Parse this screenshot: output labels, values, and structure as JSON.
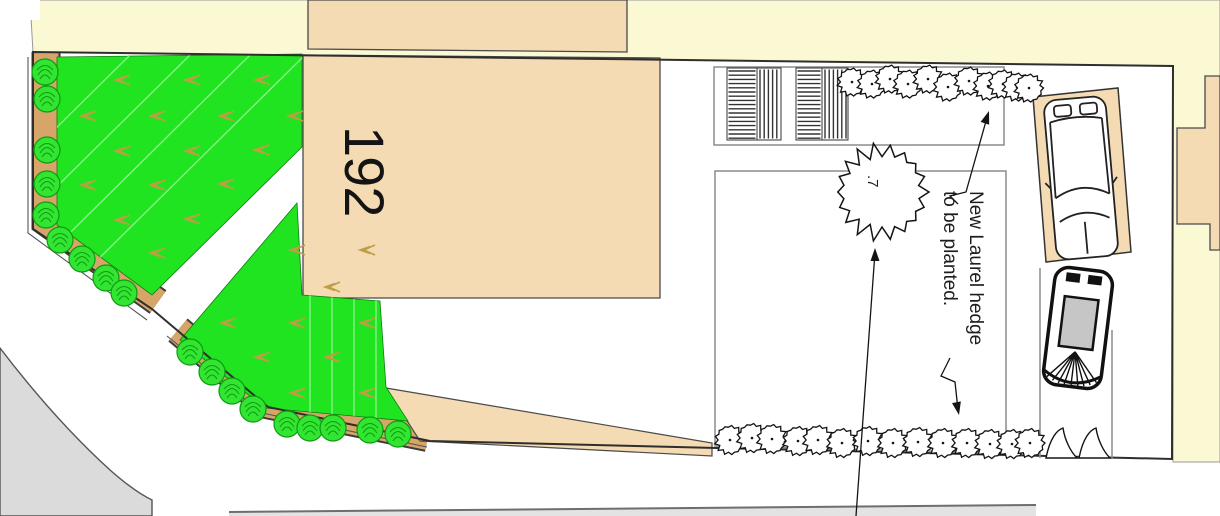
{
  "document": {
    "type": "landscape-site-plan"
  },
  "labels": {
    "house_number": "192",
    "annotation_line1": "New Laurel hedge",
    "annotation_line2": "to be planted.",
    "tree_label": ".7"
  },
  "colors": {
    "road_cream": "#FBF8D4",
    "building_tan": "#F5DBB3",
    "hedge_strip_brown": "#D7A569",
    "lawn_green": "#1FE41F",
    "lawn_stripe": "#86F286",
    "tuft_olive": "#BE9E44",
    "shrub_green": "#33E533",
    "shrub_detail": "#0E9B0E",
    "road_gray": "#DBDBDB",
    "kerb_gray": "#E3E3E3",
    "line_gray": "#8C8C8C",
    "boundary_dark": "#2E2E2E",
    "ink": "#141414",
    "glass_gray": "#C6C6C6"
  },
  "plan": {
    "tree": {
      "cx": 882,
      "cy": 192,
      "r": 47
    },
    "top_hedge_row": {
      "radius": 14.5,
      "centers": [
        [
          852,
          82
        ],
        [
          872,
          84
        ],
        [
          890,
          79
        ],
        [
          908,
          84
        ],
        [
          928,
          79
        ],
        [
          948,
          87
        ],
        [
          969,
          81
        ],
        [
          988,
          86
        ],
        [
          1003,
          84
        ],
        [
          1017,
          87
        ],
        [
          1029,
          88
        ]
      ]
    },
    "bottom_hedge_row": {
      "radius": 15,
      "centers": [
        [
          730,
          440
        ],
        [
          752,
          438
        ],
        [
          772,
          439
        ],
        [
          798,
          441
        ],
        [
          818,
          440
        ],
        [
          842,
          443
        ],
        [
          868,
          441
        ],
        [
          893,
          443
        ],
        [
          918,
          442
        ],
        [
          943,
          443
        ],
        [
          967,
          443
        ],
        [
          990,
          444
        ],
        [
          1012,
          444
        ],
        [
          1030,
          443
        ]
      ]
    },
    "border_shrubs": {
      "radius": 13,
      "centers": [
        [
          45,
          72
        ],
        [
          47,
          99
        ],
        [
          47,
          150
        ],
        [
          47,
          184
        ],
        [
          46,
          215
        ],
        [
          60,
          240
        ],
        [
          82,
          259
        ],
        [
          106,
          278
        ],
        [
          124,
          293
        ],
        [
          190,
          352
        ],
        [
          212,
          372
        ],
        [
          232,
          391
        ],
        [
          253,
          409
        ],
        [
          287,
          424
        ],
        [
          310,
          428
        ],
        [
          333,
          428
        ],
        [
          370,
          430
        ],
        [
          398,
          434
        ]
      ]
    },
    "lawn_tufts_upper": [
      [
        117,
        80
      ],
      [
        187,
        80
      ],
      [
        257,
        80
      ],
      [
        83,
        116
      ],
      [
        152,
        116
      ],
      [
        221,
        116
      ],
      [
        290,
        116
      ],
      [
        117,
        151
      ],
      [
        187,
        151
      ],
      [
        256,
        150
      ],
      [
        83,
        185
      ],
      [
        152,
        185
      ],
      [
        221,
        184
      ],
      [
        117,
        220
      ],
      [
        187,
        219
      ],
      [
        152,
        253
      ]
    ],
    "lawn_tufts_lower": [
      [
        292,
        250
      ],
      [
        362,
        250
      ],
      [
        327,
        287
      ],
      [
        223,
        323
      ],
      [
        292,
        323
      ],
      [
        362,
        323
      ],
      [
        257,
        357
      ],
      [
        327,
        357
      ],
      [
        292,
        393
      ],
      [
        362,
        393
      ]
    ],
    "hatch_panels": [
      {
        "x": 727,
        "y": 68,
        "w": 30,
        "h": 72,
        "dir": "h"
      },
      {
        "x": 757,
        "y": 68,
        "w": 24,
        "h": 72,
        "dir": "v"
      },
      {
        "x": 796,
        "y": 68,
        "w": 26,
        "h": 72,
        "dir": "h"
      },
      {
        "x": 822,
        "y": 68,
        "w": 26,
        "h": 72,
        "dir": "v"
      }
    ],
    "leaders": [
      {
        "points": [
          [
            958,
            204
          ],
          [
            950,
            196
          ],
          [
            966,
            192
          ],
          [
            988,
            114
          ]
        ],
        "tip": [
          989,
          111
        ]
      },
      {
        "points": [
          [
            950,
            358
          ],
          [
            941,
            376
          ],
          [
            955,
            382
          ],
          [
            958,
            410
          ]
        ],
        "tip": [
          959,
          415
        ]
      },
      {
        "points": [
          [
            856,
            516
          ],
          [
            875,
            252
          ]
        ],
        "tip": [
          875,
          248
        ]
      }
    ],
    "gates": [
      {
        "x": 1046
      },
      {
        "x": 1079
      }
    ]
  }
}
